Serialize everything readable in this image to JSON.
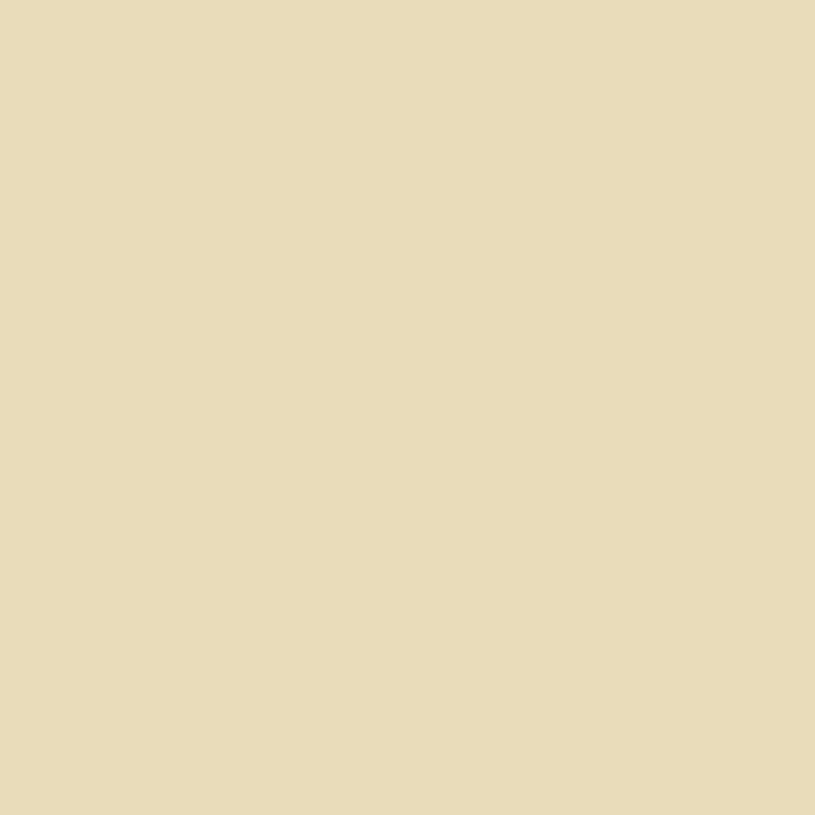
{
  "map": {
    "description_labels": {
      "river_name_parts": [
        "SOUTH",
        "BRISBANE",
        "REACH"
      ],
      "big_letter_groups": [
        "OF",
        "OF",
        "BRISBANE"
      ]
    },
    "palette": {
      "paper": "#e9dcba",
      "water": "#ecdfc2",
      "bank": "#9bbfb6",
      "street": "#e2a55e",
      "street_edge": "#574528",
      "rail_gray": "#b7b1a5",
      "track": "#6e6757",
      "park_dark": "#4f9e4e",
      "park_light": "#8fc08c",
      "domain_brown": "#7d6234",
      "margin_white": "#ffffff",
      "edge_label_red": "#c03030",
      "ink": "#3f3526"
    },
    "districts": [
      {
        "name": "north-cbd",
        "seed": 7,
        "angle": -34,
        "origin": [
          420,
          180
        ],
        "cellW": 56,
        "cellH": 40,
        "gap": 9,
        "poly": [
          [
            37,
            0
          ],
          [
            806,
            0
          ],
          [
            806,
            372
          ],
          [
            756,
            378
          ],
          [
            700,
            398
          ],
          [
            640,
            462
          ],
          [
            610,
            515
          ],
          [
            588,
            480
          ],
          [
            560,
            440
          ],
          [
            520,
            402
          ],
          [
            470,
            370
          ],
          [
            400,
            326
          ],
          [
            330,
            286
          ],
          [
            270,
            250
          ],
          [
            200,
            222
          ],
          [
            130,
            212
          ],
          [
            60,
            214
          ],
          [
            37,
            228
          ]
        ],
        "colors": [
          [
            "#24459b",
            0.34
          ],
          [
            "#1d3a88",
            0.12
          ],
          [
            "#3c5cae",
            0.1
          ],
          [
            "#8a6d35",
            0.17
          ],
          [
            "#7a5c28",
            0.05
          ],
          [
            "#e99fae",
            0.05
          ],
          [
            "#d85a6a",
            0.06
          ],
          [
            "#e0cb52",
            0.04
          ],
          [
            "#e8dcb8",
            0.07
          ]
        ]
      },
      {
        "name": "south-brisbane",
        "seed": 13,
        "angle": -42,
        "origin": [
          250,
          620
        ],
        "cellW": 52,
        "cellH": 40,
        "gap": 8,
        "poly": [
          [
            0,
            332
          ],
          [
            80,
            318
          ],
          [
            150,
            328
          ],
          [
            196,
            350
          ],
          [
            240,
            388
          ],
          [
            276,
            430
          ],
          [
            305,
            476
          ],
          [
            350,
            488
          ],
          [
            395,
            512
          ],
          [
            432,
            548
          ],
          [
            462,
            590
          ],
          [
            492,
            645
          ],
          [
            525,
            700
          ],
          [
            560,
            736
          ],
          [
            608,
            775
          ],
          [
            655,
            812
          ],
          [
            660,
            815
          ],
          [
            0,
            815
          ]
        ],
        "colors": [
          [
            "#efc3ca",
            0.34
          ],
          [
            "#eadfb8",
            0.28
          ],
          [
            "#e8a0b0",
            0.1
          ],
          [
            "#8a6d35",
            0.08
          ],
          [
            "#24459b",
            0.08
          ],
          [
            "#c8333c",
            0.04
          ],
          [
            "#d9c348",
            0.03
          ],
          [
            "#f6eed0",
            0.05
          ]
        ]
      }
    ],
    "shapes": {
      "water": "M0,236 C40,224 90,214 135,213 C185,212 225,228 272,252 C320,277 360,300 400,328 C425,345 445,356 455,362 C480,377 505,390 525,408 C550,430 572,452 590,478 C608,503 618,530 632,562 C645,592 658,628 672,655 C690,688 712,712 742,728 C768,741 790,748 806,752 L806,815 L662,815 C645,800 620,782 600,764 C575,740 552,716 532,692 C510,664 488,628 470,598 C452,568 440,550 425,535 C405,515 385,502 362,492 C340,483 320,480 303,477 C288,460 270,435 255,415 C235,388 215,365 196,350 C170,330 140,326 110,322 C75,318 35,324 0,334 Z",
      "bank_north": "M0,244 C90,222 180,222 272,260 C350,292 420,340 455,370 C500,400 550,440 585,485 C615,525 635,575 668,648 C690,690 715,712 745,728 C770,740 790,746 806,752",
      "bank_south": "M0,326 C60,318 120,320 196,344 C240,362 270,400 300,440 C320,465 340,478 365,488 C395,500 420,520 445,552 C470,588 495,640 530,690 C560,728 610,770 660,812",
      "bank_bottom": "M672,806 C720,800 770,802 806,810",
      "corner_land": "M660,815 L806,815 L806,808 C760,800 710,800 672,806 Z",
      "road_north_quay": "M55,208 C150,198 230,224 300,262 C360,295 420,335 452,356",
      "road_stanley": "M140,330 C190,345 230,375 262,412 C285,440 298,462 306,476 C340,486 380,502 420,532 C445,555 462,580 478,606 C495,640 515,672 536,700",
      "yards": "M60,95 C65,45 75,12 85,0 L368,0 C352,25 330,55 300,85 C262,122 215,158 170,185 C140,202 110,210 88,208 C70,190 62,150 60,95 Z",
      "yard_tracks": [
        "M70,150 C140,95 220,45 330,8",
        "M72,165 C150,112 240,62 352,18",
        "M76,182 C160,132 255,82 330,55",
        "M82,196 C170,152 260,110 345,70",
        "M90,204 C200,190 330,110 470,40"
      ],
      "central_station": "M452,0 L562,0 C560,28 548,52 528,74 C512,90 495,96 482,86 C465,72 456,40 452,0 Z",
      "central_tracks": [
        "M470,8 C480,40 495,62 515,78",
        "M482,4 C492,34 506,56 524,70"
      ],
      "south_station": "M210,560 L276,524 C330,585 390,650 440,712 C462,742 478,772 488,800 L482,815 L352,815 C320,770 280,715 245,660 C228,630 216,595 210,560 Z",
      "south_tracks": [
        "M230,566 L462,802",
        "M240,560 L472,796",
        "M250,554 L482,792",
        "M222,574 L452,810",
        "M262,550 L490,784"
      ],
      "park_wickham": "M286,10 L340,32 C362,50 380,72 392,92 L360,112 C330,85 305,55 284,32 Z",
      "park_musgrave": "M184,686 L302,742 L246,815 L150,815 L140,772 Z",
      "gardens": "M632,470 C660,435 690,408 718,392 C748,380 780,375 806,374 L806,556 C780,568 755,576 735,580 C710,560 685,535 662,512 C650,498 638,484 632,470 Z",
      "domain": "M640,565 C670,580 700,580 735,582 C760,578 785,568 806,560 L806,735 C785,726 760,712 738,695 C712,672 690,645 672,618 C658,598 648,580 640,565 Z",
      "eagle_triangle": "M712,92 L728,96 L716,112 Z",
      "big_red_block": "M106,282 C130,272 155,272 178,286 C184,300 182,316 172,330 L128,336 C114,322 106,302 106,282 Z",
      "margin_left": "M0,0 L37,0 L34,130 L39,260 L31,400 L27,424 L0,436 Z",
      "margin_right": "M789,0 L815,0 L815,815 L806,815 L802,690 L806,500 L799,300 L797,170 L786,80 Z"
    },
    "depot_rects": [
      {
        "x": 215,
        "y": 28,
        "w": 85,
        "h": 16,
        "r": -28
      },
      {
        "x": 235,
        "y": 62,
        "w": 60,
        "h": 13,
        "r": -28
      },
      {
        "x": 150,
        "y": 18,
        "w": 48,
        "h": 11,
        "r": -28
      },
      {
        "x": 492,
        "y": 30,
        "w": 52,
        "h": 7,
        "r": -33
      },
      {
        "x": 500,
        "y": 46,
        "w": 46,
        "h": 6,
        "r": -33
      },
      {
        "x": 300,
        "y": 600,
        "w": 120,
        "h": 16,
        "r": 48
      }
    ],
    "feature_blocks": [
      {
        "x": 396,
        "y": 552,
        "w": 52,
        "h": 40,
        "r": -42,
        "c": "#c8333c"
      },
      {
        "x": 252,
        "y": 676,
        "w": 56,
        "h": 42,
        "r": -42,
        "c": "#c8333c"
      },
      {
        "x": 610,
        "y": 772,
        "w": 64,
        "h": 32,
        "r": -48,
        "c": "#d14b56"
      },
      {
        "x": 576,
        "y": 10,
        "w": 16,
        "h": 22,
        "r": -33,
        "c": "#c8333c"
      },
      {
        "x": 38,
        "y": 128,
        "w": 20,
        "h": 42,
        "r": -8,
        "c": "#58a050"
      },
      {
        "x": 76,
        "y": 138,
        "w": 36,
        "h": 26,
        "r": -14,
        "c": "#c8333c"
      },
      {
        "x": 98,
        "y": 158,
        "w": 26,
        "h": 20,
        "r": -14,
        "c": "#d9c348"
      },
      {
        "x": 128,
        "y": 158,
        "w": 40,
        "h": 26,
        "r": -14,
        "c": "#8a6d35"
      },
      {
        "x": 200,
        "y": 645,
        "w": 24,
        "h": 18,
        "r": -42,
        "c": "#d9c348"
      },
      {
        "x": 556,
        "y": 44,
        "w": 34,
        "h": 30,
        "r": -33,
        "c": "#8fc177"
      },
      {
        "x": 438,
        "y": 36,
        "w": 26,
        "h": 24,
        "r": -33,
        "c": "#8fc177"
      },
      {
        "x": 652,
        "y": 598,
        "w": 46,
        "h": 40,
        "r": 40,
        "c": "#7a5c28"
      },
      {
        "x": 676,
        "y": 478,
        "w": 40,
        "h": 34,
        "r": 40,
        "c": "#8a6d35"
      }
    ],
    "wharves": [
      {
        "x": 488,
        "y": 396,
        "w": 28,
        "h": 11,
        "r": 42
      },
      {
        "x": 508,
        "y": 414,
        "w": 26,
        "h": 11,
        "r": 44
      },
      {
        "x": 528,
        "y": 434,
        "w": 24,
        "h": 10,
        "r": 46
      },
      {
        "x": 546,
        "y": 455,
        "w": 22,
        "h": 10,
        "r": 50
      }
    ],
    "bridges": [
      {
        "d": "M57,182 L102,300",
        "w": 9
      },
      {
        "d": "M303,480 L452,357",
        "w": 10
      }
    ],
    "edge_label": {
      "x": 750,
      "y": 124,
      "w": 9,
      "h": 52
    },
    "labels": [
      {
        "t": "RAILWAY",
        "x": 152,
        "y": 14,
        "r": 6,
        "s": 9,
        "ls": 2,
        "c": "#4f4a3b",
        "f": "serif"
      },
      {
        "t": "YARDS",
        "x": 168,
        "y": 46,
        "r": 6,
        "s": 9,
        "ls": 2,
        "c": "#4f4a3b",
        "f": "serif"
      },
      {
        "t": "ROMA ST",
        "x": 200,
        "y": 60,
        "r": 14,
        "s": 4.5,
        "ls": 1
      },
      {
        "t": "CENTRAL RAILWAY STATION",
        "x": 528,
        "y": 44,
        "r": 47,
        "s": 4.5,
        "ls": 0.8,
        "c": "#474132"
      },
      {
        "t": "QUEEN ST",
        "x": 466,
        "y": 344,
        "r": -35,
        "s": 4.5,
        "ls": 0.8
      },
      {
        "t": "ALBERT ST",
        "x": 314,
        "y": 58,
        "r": 52,
        "s": 4.5,
        "ls": 0.8
      },
      {
        "t": "EAGLE ST",
        "x": 722,
        "y": 122,
        "r": 80,
        "s": 4.5,
        "ls": 0.8
      },
      {
        "t": "EAGLE ST",
        "x": 748,
        "y": 288,
        "r": 62,
        "s": 4.5,
        "ls": 0.8
      },
      {
        "t": "MARKET ST",
        "x": 700,
        "y": 354,
        "r": 52,
        "s": 4.5,
        "ls": 0.8
      },
      {
        "t": "CHARLOTTE ST",
        "x": 578,
        "y": 334,
        "r": 52,
        "s": 4.5,
        "ls": 0.8
      },
      {
        "t": "MARY ST",
        "x": 608,
        "y": 392,
        "r": 52,
        "s": 4.5,
        "ls": 0.8
      },
      {
        "t": "MARGARET ST",
        "x": 590,
        "y": 497,
        "r": 52,
        "s": 4.5,
        "ls": 0.8
      },
      {
        "t": "STANLEY ST",
        "x": 204,
        "y": 330,
        "r": 72,
        "s": 4.5,
        "ls": 0.8
      },
      {
        "t": "ROAD",
        "x": 154,
        "y": 320,
        "r": 40,
        "s": 4.5,
        "ls": 0.8
      },
      {
        "t": "SOUTH COAST",
        "x": 342,
        "y": 630,
        "r": 48,
        "s": 5,
        "ls": 1,
        "c": "#5a5242",
        "i": 1
      },
      {
        "t": "SOUTH BRISBANE",
        "x": 250,
        "y": 564,
        "r": 47,
        "s": 5,
        "ls": 0.8,
        "c": "#4f4a3b"
      },
      {
        "t": "RAILWAY STATION",
        "x": 262,
        "y": 588,
        "r": 47,
        "s": 5,
        "ls": 0.8,
        "c": "#4f4a3b"
      },
      {
        "t": "Victoria Bridge",
        "x": 374,
        "y": 428,
        "r": -39,
        "s": 4.5,
        "ls": 0.5,
        "f": "serif",
        "i": 1
      },
      {
        "t": "SOUTH",
        "x": 282,
        "y": 316,
        "r": 31,
        "s": 13,
        "ls": 9,
        "c": "#4a4336",
        "f": "serif"
      },
      {
        "t": "BRISBANE",
        "x": 452,
        "y": 462,
        "r": 46,
        "s": 11,
        "ls": 5,
        "c": "#4a4336",
        "f": "serif"
      },
      {
        "t": "REACH",
        "x": 610,
        "y": 652,
        "r": 45,
        "s": 13,
        "ls": 8,
        "c": "#4a4336",
        "f": "serif"
      },
      {
        "t": "WICKHAM",
        "x": 334,
        "y": 50,
        "r": 44,
        "s": 6.5,
        "ls": 2,
        "c": "#1f3a20",
        "f": "serif"
      },
      {
        "t": "PARK",
        "x": 370,
        "y": 86,
        "r": 44,
        "s": 6.5,
        "ls": 2,
        "c": "#1f3a20",
        "f": "serif"
      },
      {
        "t": "325",
        "x": 320,
        "y": 32,
        "r": 44,
        "s": 5.5,
        "ls": 0,
        "c": "#1f3a20"
      },
      {
        "t": "218",
        "x": 222,
        "y": 736,
        "r": 43,
        "s": 6,
        "ls": 0,
        "c": "#1f3a20"
      },
      {
        "t": "MUSGRAVE PARK",
        "x": 226,
        "y": 758,
        "r": 43,
        "s": 7,
        "ls": 2,
        "c": "#1f3a20",
        "f": "serif"
      },
      {
        "t": "BOT",
        "x": 760,
        "y": 414,
        "r": 0,
        "s": 8,
        "ls": 3,
        "c": "#2e4d2f",
        "f": "serif"
      },
      {
        "t": "GA",
        "x": 758,
        "y": 490,
        "r": 0,
        "s": 8,
        "ls": 3,
        "c": "#2e4d2f",
        "f": "serif"
      },
      {
        "t": "DOM",
        "x": 746,
        "y": 652,
        "r": 42,
        "s": 8,
        "ls": 2,
        "c": "#4a3d22",
        "f": "serif",
        "i": 1
      },
      {
        "t": "405",
        "x": 678,
        "y": 600,
        "r": 40,
        "s": 5,
        "ls": 0
      },
      {
        "t": "414",
        "x": 694,
        "y": 502,
        "r": 40,
        "s": 5,
        "ls": 0
      },
      {
        "t": "291A",
        "x": 452,
        "y": 50,
        "r": 0,
        "s": 4.5,
        "ls": 0
      },
      {
        "t": "428",
        "x": 402,
        "y": 58,
        "r": 0,
        "s": 4.5,
        "ls": 0
      },
      {
        "t": "XXVI",
        "x": 572,
        "y": 60,
        "r": -33,
        "s": 5.5,
        "ls": 1,
        "f": "serif"
      },
      {
        "t": "SQUARE",
        "x": 576,
        "y": 70,
        "r": -33,
        "s": 3.8,
        "ls": 1
      },
      {
        "t": "VII",
        "x": 702,
        "y": 296,
        "r": -33,
        "s": 5,
        "ls": 0,
        "f": "serif"
      },
      {
        "t": "XXIII",
        "x": 704,
        "y": 150,
        "r": -33,
        "s": 5,
        "ls": 0,
        "f": "serif"
      },
      {
        "t": "XI",
        "x": 68,
        "y": 470,
        "r": -42,
        "s": 5,
        "ls": 0,
        "f": "serif"
      },
      {
        "t": "XL",
        "x": 172,
        "y": 464,
        "r": -42,
        "s": 5,
        "ls": 0,
        "f": "serif"
      },
      {
        "t": "XXI",
        "x": 322,
        "y": 692,
        "r": -42,
        "s": 5,
        "ls": 0,
        "f": "serif"
      }
    ],
    "big_letters": [
      {
        "ch": "O",
        "x": 190,
        "y": 130,
        "s": 30
      },
      {
        "ch": "F",
        "x": 226,
        "y": 130,
        "s": 30
      },
      {
        "ch": "O",
        "x": 234,
        "y": 546,
        "s": 30
      },
      {
        "ch": "F",
        "x": 270,
        "y": 546,
        "s": 30
      },
      {
        "ch": "B",
        "x": 566,
        "y": 480,
        "s": 40
      },
      {
        "ch": "R",
        "x": 602,
        "y": 480,
        "s": 40
      },
      {
        "ch": "I",
        "x": 630,
        "y": 480,
        "s": 40
      },
      {
        "ch": "S",
        "x": 658,
        "y": 480,
        "s": 40
      },
      {
        "ch": "B",
        "x": 694,
        "y": 480,
        "s": 40
      },
      {
        "ch": "A",
        "x": 732,
        "y": 480,
        "s": 40
      },
      {
        "ch": "N",
        "x": 768,
        "y": 480,
        "s": 40
      },
      {
        "ch": "E",
        "x": 800,
        "y": 480,
        "s": 40
      }
    ]
  }
}
